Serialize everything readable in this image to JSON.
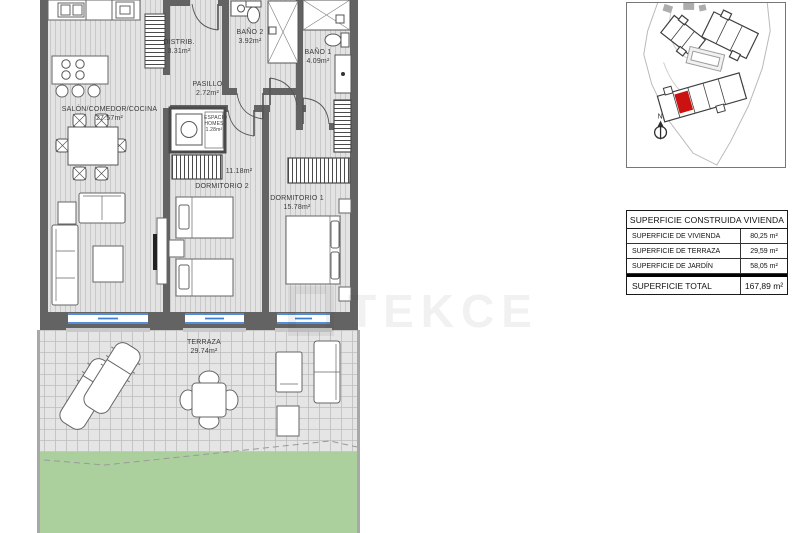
{
  "watermark": {
    "text": "TEKCE"
  },
  "site_map": {
    "north_label": "N"
  },
  "rooms": {
    "salon": {
      "name": "SALÓN/COMEDOR/COCINA",
      "area": "27.57m²"
    },
    "distrib": {
      "name": "DISTRIB.",
      "area": "3.31m²"
    },
    "bano2": {
      "name": "BAÑO 2",
      "area": "3.92m²"
    },
    "bano1": {
      "name": "BAÑO 1",
      "area": "4.09m²"
    },
    "pasillo": {
      "name": "PASILLO",
      "area": "2.72m²"
    },
    "espacio": {
      "name": "ESPACIO HOMES",
      "area": "1.28m²"
    },
    "dormitorio2": {
      "name": "DORMITORIO 2",
      "area": "11.18m²"
    },
    "dormitorio1": {
      "name": "DORMITORIO 1",
      "area": "15.78m²"
    },
    "terraza": {
      "name": "TERRAZA",
      "area": "29.74m²"
    }
  },
  "area_table": {
    "header": "SUPERFICIE CONSTRUIDA VIVIENDA",
    "rows": [
      {
        "label": "SUPERFICIE DE VIVIENDA",
        "value": "80,25 m²"
      },
      {
        "label": "SUPERFICIE DE TERRAZA",
        "value": "29,59 m²"
      },
      {
        "label": "SUPERFICIE DE JARDÍN",
        "value": "58,05 m²"
      }
    ],
    "total_label": "SUPERFICIE TOTAL",
    "total_value": "167,89 m²"
  },
  "colors": {
    "unit_highlight_red": "#cc1111",
    "window_blue": "#3d7fd0",
    "garden_green": "#abd09e",
    "wall_gray": "#636363"
  }
}
